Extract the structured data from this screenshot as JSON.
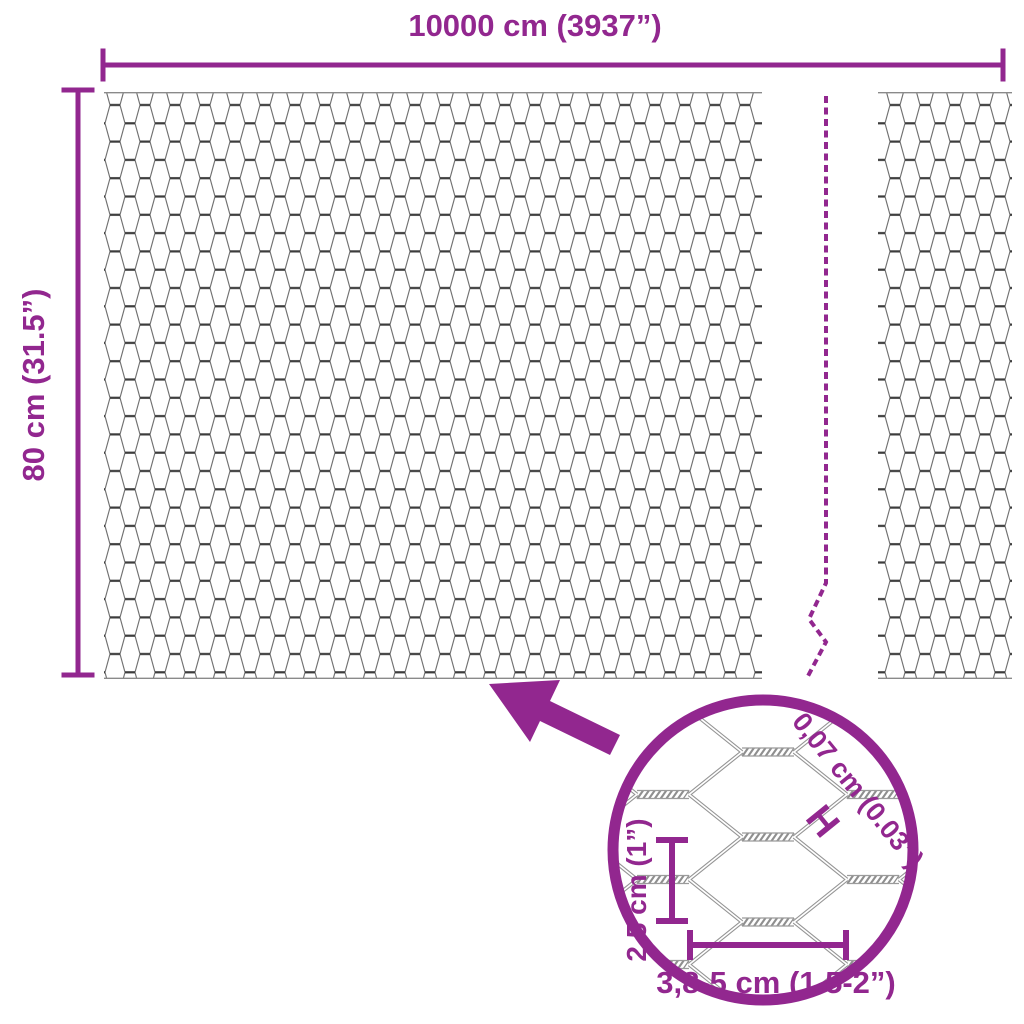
{
  "accent_color": "#92278F",
  "wire_color": "#6f6f6f",
  "top_dimension": {
    "label": "10000 cm (3937”)"
  },
  "side_dimension": {
    "label": "80 cm (31.5”)"
  },
  "magnified_detail": {
    "wire_thickness": {
      "label": "0,07 cm (0.03”)",
      "marker": "H"
    },
    "mesh_height": {
      "label": "2,5 cm (1”)"
    },
    "mesh_size": {
      "label": "3,8-5 cm (1.5-2”)"
    }
  }
}
